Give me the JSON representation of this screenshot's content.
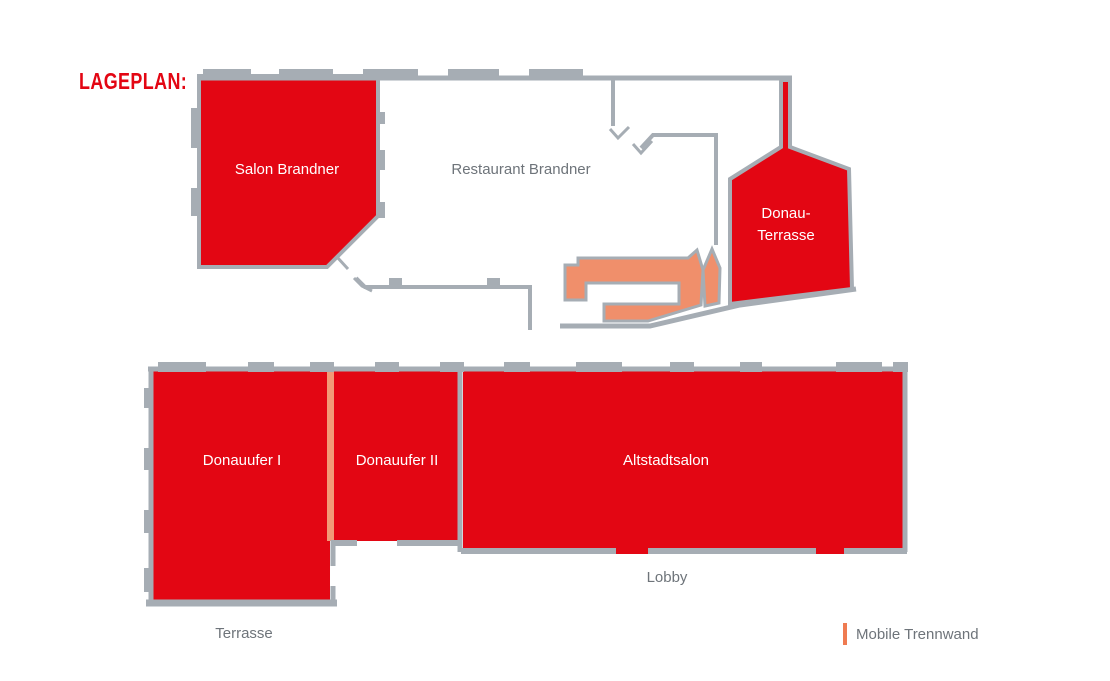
{
  "title": "LAGEPLAN:",
  "rooms": {
    "salon_brandner": {
      "label": "Salon Brandner"
    },
    "restaurant_brandner": {
      "label": "Restaurant Brandner"
    },
    "donau_terrasse": {
      "label_line1": "Donau-",
      "label_line2": "Terrasse"
    },
    "donauufer_1": {
      "label": "Donauufer I"
    },
    "donauufer_2": {
      "label": "Donauufer II"
    },
    "altstadtsalon": {
      "label": "Altstadtsalon"
    }
  },
  "areas": {
    "terrasse": {
      "label": "Terrasse"
    },
    "lobby": {
      "label": "Lobby"
    }
  },
  "legend": {
    "marker": "mobile-partition-bar",
    "label": "Mobile Trennwand"
  },
  "colors": {
    "room_red": "#e30613",
    "stairs_salmon": "#f08f6b",
    "partition_salmon": "#f29a77",
    "legend_orange": "#ef7b51",
    "wall_gray": "#a6adb4",
    "text_gray": "#6e747a",
    "label_white": "#ffffff",
    "background": "#ffffff"
  }
}
